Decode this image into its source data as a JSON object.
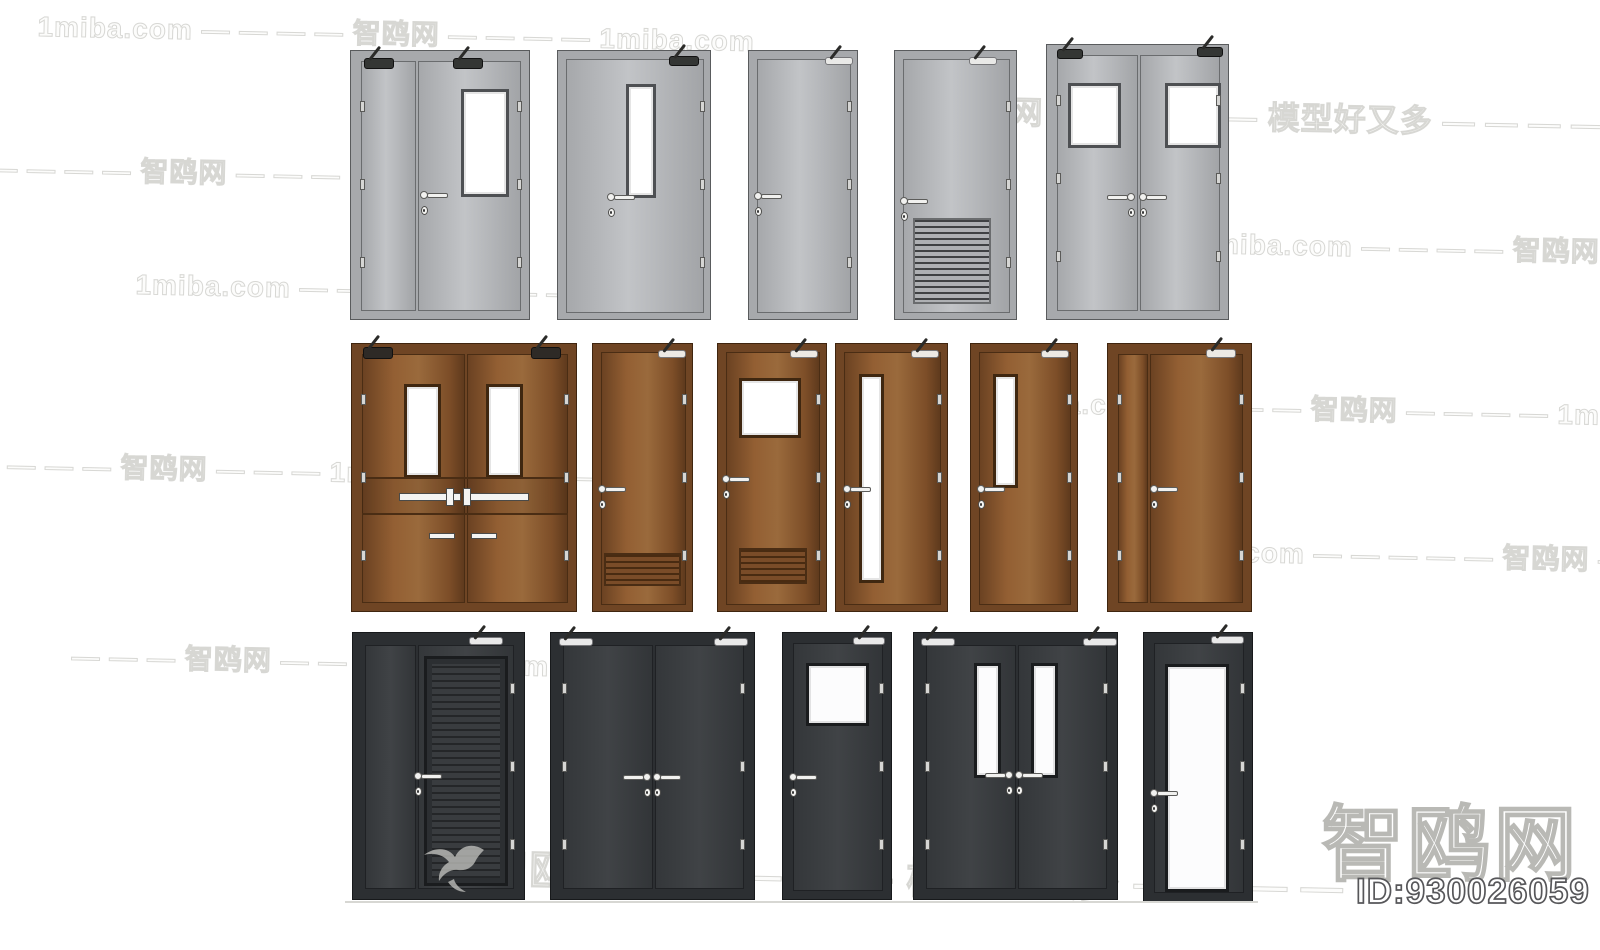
{
  "branding": {
    "logo_text": "智鸥网",
    "id_label": "ID:930026059",
    "logo_stroke_color": "#b9b9b5",
    "id_stroke_color": "#57575a",
    "bird_icon": "seagull-icon",
    "bird_color": "#c6c6c2"
  },
  "watermarks": [
    {
      "text": "1miba.com — — — — 智鸥网 — — — — 1miba.com",
      "x": 38,
      "y": 5,
      "size": 28
    },
    {
      "text": "智鸥网 — — — — — 模型好又多 — — — —",
      "x": 945,
      "y": 86,
      "size": 32
    },
    {
      "text": "— — — — — 智鸥网 — — — 1miba.com",
      "x": -48,
      "y": 146,
      "size": 28
    },
    {
      "text": "1miba.com — — — — 智鸥网 — —",
      "x": 1198,
      "y": 222,
      "size": 28
    },
    {
      "text": "1miba.com — — — 智鸥网 — — — —",
      "x": 136,
      "y": 263,
      "size": 28
    },
    {
      "text": "1miba.com — — — — 智鸥网 — — — — 1miba.com",
      "x": 996,
      "y": 381,
      "size": 28
    },
    {
      "text": "— — — — 智鸥网 — — — 1miba.com — — —",
      "x": -30,
      "y": 443,
      "size": 28
    },
    {
      "text": "1miba.com — — — — — 智鸥网 — — — —",
      "x": 1150,
      "y": 529,
      "size": 28
    },
    {
      "text": "— — — 智鸥网 — — — 1miba.com",
      "x": 72,
      "y": 635,
      "size": 28
    },
    {
      "text": "智鸥网 — — — — — 模型好又多 — — — —",
      "x": 487,
      "y": 836,
      "size": 42
    }
  ],
  "palettes": {
    "gray": {
      "frame": "#a7a9ac",
      "frameBorder": "#595b5d",
      "leaf": "linear-gradient(90deg,#a6a8ab,#c2c4c7 45%,#b7b9bc 65%,#a2a4a7)",
      "line": "#6a6c6e",
      "windowFrame": "#4e5053",
      "glass": "#ffffff",
      "louverBg": "#aeb0b3",
      "louverStripe": "#3f4143",
      "closerDark": "#343634",
      "closerLight": "#e9e9e7"
    },
    "brown": {
      "frame": "#6f4524",
      "frameBorder": "#3f250f",
      "leaf": "linear-gradient(90deg,#6b4222,#935f33 30%,#9a6a3c 55%,#7d4e28 85%,#5f3a1d)",
      "line": "#4a2d14",
      "windowFrame": "#3f2710",
      "glass": "#ffffff",
      "louverBg": "#7a4c28",
      "louverStripe": "#492b11",
      "closerDark": "#2e2a26",
      "closerLight": "#ece9e4"
    },
    "dark": {
      "frame": "#2c2f32",
      "frameBorder": "#17191b",
      "leaf": "linear-gradient(90deg,#34373a,#404346 50%,#323538)",
      "line": "#1f2124",
      "windowFrame": "#1a1c1e",
      "glass": "#fcfcfd",
      "louverBg": "#393c3f",
      "louverStripe": "#242628",
      "closerDark": "#232523",
      "closerLight": "#e9e9e9"
    }
  },
  "ground_line": {
    "x": 345,
    "y": 901,
    "w": 913,
    "h": 2
  },
  "doors": [
    {
      "name": "steel-double-door-vision-panel",
      "palette": "gray",
      "x": 350,
      "y": 50,
      "w": 180,
      "h": 270,
      "frame": 10,
      "leaves": [
        [
          10,
          55
        ],
        [
          67,
          103
        ]
      ],
      "windows": [
        [
          110,
          38,
          48,
          108
        ]
      ],
      "handles": [
        [
          73,
          144,
          "r"
        ]
      ],
      "closers": [
        [
          13,
          7,
          30,
          11,
          "dark"
        ],
        [
          102,
          7,
          30,
          11,
          "dark"
        ]
      ],
      "hinges": "both"
    },
    {
      "name": "steel-door-narrow-vision",
      "palette": "gray",
      "x": 557,
      "y": 50,
      "w": 154,
      "h": 270,
      "frame": 8,
      "leaves": [
        [
          8,
          138
        ]
      ],
      "windows": [
        [
          68,
          33,
          30,
          114
        ]
      ],
      "handles": [
        [
          53,
          146,
          "r"
        ]
      ],
      "closers": [
        [
          111,
          5,
          30,
          10,
          "dark"
        ]
      ],
      "hinges": "right"
    },
    {
      "name": "steel-door-plain",
      "palette": "gray",
      "x": 748,
      "y": 50,
      "w": 110,
      "h": 270,
      "frame": 8,
      "leaves": [
        [
          8,
          94
        ]
      ],
      "handles": [
        [
          9,
          145,
          "r"
        ]
      ],
      "closers": [
        [
          76,
          6,
          28,
          8,
          "light"
        ]
      ],
      "hinges": "right"
    },
    {
      "name": "steel-door-louver",
      "palette": "gray",
      "x": 894,
      "y": 50,
      "w": 123,
      "h": 270,
      "frame": 8,
      "leaves": [
        [
          8,
          107
        ]
      ],
      "louvers": [
        [
          18,
          167,
          78,
          86
        ]
      ],
      "handles": [
        [
          9,
          150,
          "r"
        ]
      ],
      "closers": [
        [
          74,
          6,
          28,
          8,
          "light"
        ]
      ],
      "hinges": "right"
    },
    {
      "name": "steel-double-door-square-windows",
      "palette": "gray",
      "x": 1046,
      "y": 44,
      "w": 183,
      "h": 276,
      "frame": 10,
      "leaves": [
        [
          10,
          81
        ],
        [
          93,
          80
        ]
      ],
      "windows": [
        [
          21,
          38,
          53,
          65
        ],
        [
          118,
          38,
          56,
          65
        ]
      ],
      "handles": [
        [
          84,
          152,
          "l"
        ],
        [
          96,
          152,
          "r"
        ]
      ],
      "closers": [
        [
          10,
          4,
          26,
          10,
          "dark"
        ],
        [
          150,
          2,
          26,
          10,
          "dark"
        ]
      ],
      "hinges": "both"
    },
    {
      "name": "wood-double-door-panic-bar",
      "palette": "brown",
      "x": 351,
      "y": 343,
      "w": 226,
      "h": 269,
      "frame": 10,
      "leaves": [
        [
          10,
          103
        ],
        [
          115,
          101
        ]
      ],
      "windows": [
        [
          52,
          40,
          37,
          94
        ],
        [
          134,
          40,
          37,
          94
        ]
      ],
      "band": [
        10,
        133,
        206,
        38
      ],
      "bars": [
        [
          47,
          149,
          62,
          8
        ],
        [
          115,
          149,
          62,
          8
        ],
        [
          94,
          144,
          8,
          18
        ],
        [
          111,
          144,
          8,
          18
        ],
        [
          77,
          189,
          26,
          6
        ],
        [
          119,
          189,
          26,
          6
        ]
      ],
      "closers": [
        [
          11,
          3,
          30,
          12,
          "dark"
        ],
        [
          179,
          3,
          30,
          12,
          "dark"
        ]
      ],
      "hinges": "both"
    },
    {
      "name": "wood-door-louver",
      "palette": "brown",
      "x": 592,
      "y": 343,
      "w": 101,
      "h": 269,
      "frame": 8,
      "leaves": [
        [
          8,
          85
        ]
      ],
      "louvers": [
        [
          11,
          209,
          77,
          33
        ]
      ],
      "handles": [
        [
          9,
          145,
          "r"
        ]
      ],
      "closers": [
        [
          65,
          6,
          28,
          8,
          "light"
        ]
      ],
      "hinges": "right"
    },
    {
      "name": "wood-door-window-louver",
      "palette": "brown",
      "x": 717,
      "y": 343,
      "w": 110,
      "h": 269,
      "frame": 8,
      "leaves": [
        [
          8,
          94
        ]
      ],
      "windows": [
        [
          21,
          34,
          62,
          60
        ]
      ],
      "louvers": [
        [
          21,
          204,
          68,
          36
        ]
      ],
      "handles": [
        [
          8,
          135,
          "r"
        ]
      ],
      "closers": [
        [
          72,
          6,
          28,
          8,
          "light"
        ]
      ],
      "hinges": "right"
    },
    {
      "name": "wood-door-tall-vision",
      "palette": "brown",
      "x": 835,
      "y": 343,
      "w": 113,
      "h": 269,
      "frame": 8,
      "leaves": [
        [
          8,
          97
        ]
      ],
      "windows": [
        [
          23,
          30,
          25,
          209
        ]
      ],
      "handles": [
        [
          11,
          145,
          "r"
        ]
      ],
      "closers": [
        [
          75,
          6,
          28,
          8,
          "light"
        ]
      ],
      "hinges": "right"
    },
    {
      "name": "wood-door-short-vision",
      "palette": "brown",
      "x": 970,
      "y": 343,
      "w": 108,
      "h": 269,
      "frame": 8,
      "leaves": [
        [
          8,
          92
        ]
      ],
      "windows": [
        [
          22,
          30,
          25,
          114
        ]
      ],
      "handles": [
        [
          10,
          145,
          "r"
        ]
      ],
      "closers": [
        [
          70,
          6,
          28,
          8,
          "light"
        ]
      ],
      "hinges": "right"
    },
    {
      "name": "wood-double-door-plain",
      "palette": "brown",
      "x": 1107,
      "y": 343,
      "w": 145,
      "h": 269,
      "frame": 10,
      "leaves": [
        [
          10,
          30
        ],
        [
          42,
          93
        ]
      ],
      "handles": [
        [
          46,
          145,
          "r"
        ]
      ],
      "closers": [
        [
          98,
          5,
          30,
          9,
          "light"
        ]
      ],
      "hinges": "both"
    },
    {
      "name": "dark-double-door-louver-panel",
      "palette": "dark",
      "x": 352,
      "y": 632,
      "w": 173,
      "h": 268,
      "frame": 12,
      "leaves": [
        [
          12,
          51
        ],
        [
          65,
          96
        ]
      ],
      "louverpanels": [
        [
          71,
          23,
          84,
          230
        ]
      ],
      "handles": [
        [
          65,
          143,
          "r"
        ]
      ],
      "closers": [
        [
          116,
          4,
          34,
          8,
          "light"
        ]
      ],
      "hinges": "right"
    },
    {
      "name": "dark-double-door-plain",
      "palette": "dark",
      "x": 550,
      "y": 632,
      "w": 205,
      "h": 268,
      "frame": 12,
      "leaves": [
        [
          12,
          90
        ],
        [
          104,
          89
        ]
      ],
      "handles": [
        [
          96,
          144,
          "l"
        ],
        [
          106,
          144,
          "r"
        ]
      ],
      "closers": [
        [
          8,
          5,
          34,
          8,
          "light"
        ],
        [
          163,
          5,
          34,
          8,
          "light"
        ]
      ],
      "hinges": "both"
    },
    {
      "name": "dark-door-square-window",
      "palette": "dark",
      "x": 782,
      "y": 632,
      "w": 110,
      "h": 268,
      "frame": 10,
      "leaves": [
        [
          10,
          90
        ]
      ],
      "windows": [
        [
          23,
          30,
          63,
          63
        ]
      ],
      "handles": [
        [
          10,
          144,
          "r"
        ]
      ],
      "closers": [
        [
          70,
          4,
          32,
          8,
          "light"
        ]
      ],
      "hinges": "right"
    },
    {
      "name": "dark-double-door-vision-panels",
      "palette": "dark",
      "x": 913,
      "y": 632,
      "w": 205,
      "h": 268,
      "frame": 12,
      "leaves": [
        [
          12,
          90
        ],
        [
          104,
          89
        ]
      ],
      "windows": [
        [
          60,
          30,
          27,
          115
        ],
        [
          117,
          30,
          27,
          115
        ]
      ],
      "handles": [
        [
          95,
          142,
          "l"
        ],
        [
          105,
          142,
          "r"
        ]
      ],
      "closers": [
        [
          7,
          5,
          34,
          8,
          "light"
        ],
        [
          169,
          5,
          34,
          8,
          "light"
        ]
      ],
      "hinges": "both"
    },
    {
      "name": "dark-door-glass",
      "palette": "dark",
      "x": 1143,
      "y": 632,
      "w": 110,
      "h": 270,
      "frame": 10,
      "leaves": [
        [
          10,
          90
        ]
      ],
      "windows": [
        [
          21,
          31,
          64,
          228
        ]
      ],
      "handles": [
        [
          10,
          160,
          "r"
        ]
      ],
      "closers": [
        [
          67,
          3,
          33,
          8,
          "light"
        ]
      ],
      "hinges": "right"
    }
  ]
}
